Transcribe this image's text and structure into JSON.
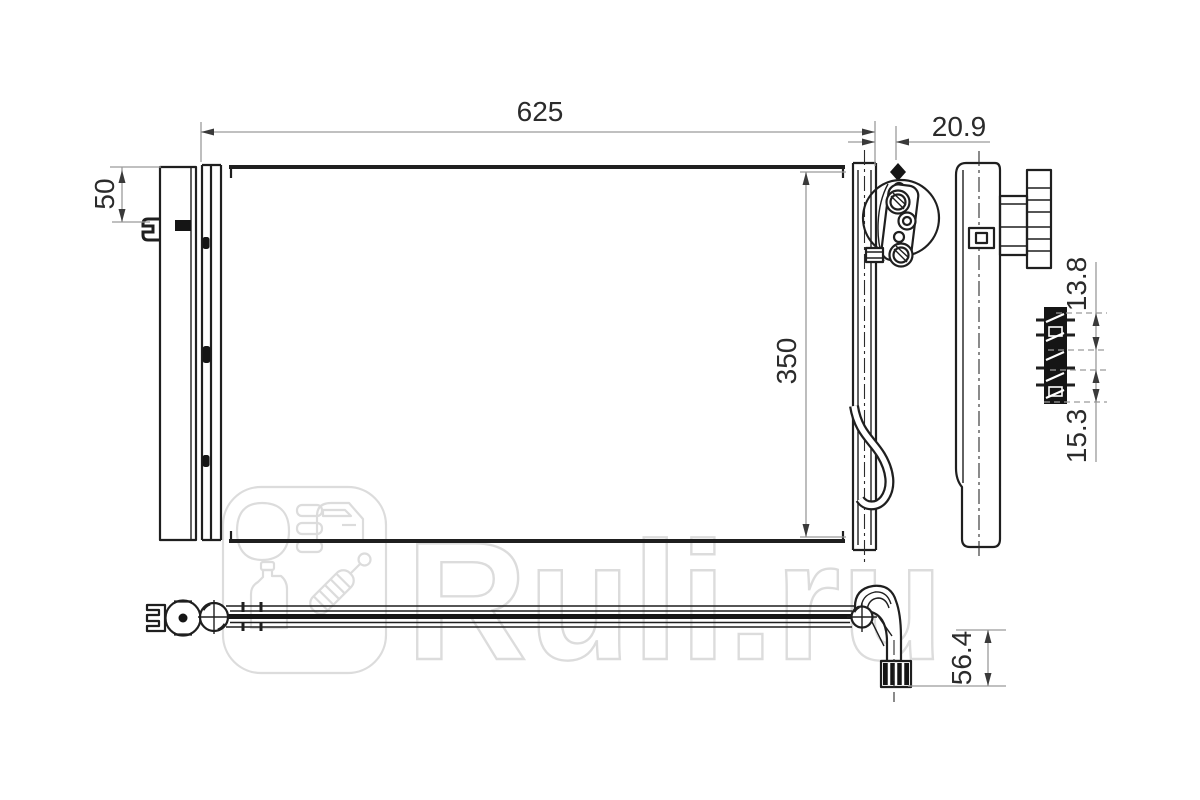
{
  "watermark": {
    "text": "Ruli.ru"
  },
  "dimensions": {
    "core_width": "625",
    "right_offset": "20.9",
    "left_bracket_height": "50",
    "core_height": "350",
    "clip_spacing_upper": "13.8",
    "clip_spacing_lower": "15.3",
    "outlet_drop": "56.4"
  },
  "colors": {
    "background": "#ffffff",
    "outline": "#1f1f1f",
    "dimension_line": "#9a9a9a",
    "dimension_text": "#2b2b2b",
    "watermark": "#dcdcdc"
  },
  "icons": {
    "badge": "ruli-logo-badge",
    "badge_icons": [
      "headlight-icon",
      "car-door-icon",
      "oil-canister-icon",
      "shock-absorber-icon"
    ]
  }
}
